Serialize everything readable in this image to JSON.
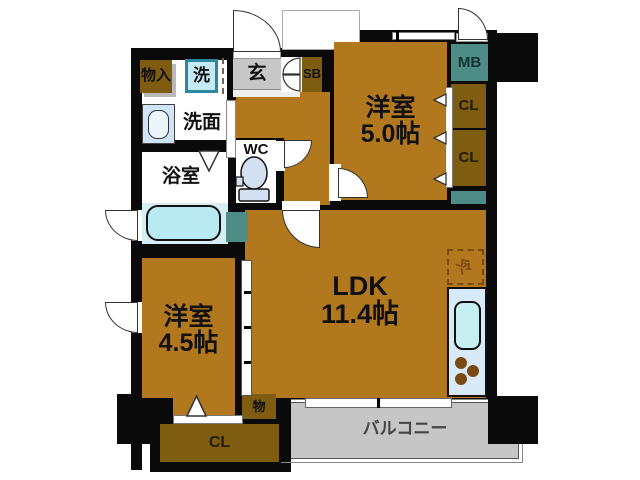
{
  "rooms": {
    "bedroom_top": {
      "name": "洋室",
      "size": "5.0帖"
    },
    "bedroom_left": {
      "name": "洋室",
      "size": "4.5帖"
    },
    "ldk": {
      "name": "LDK",
      "size": "11.4帖"
    },
    "bath": {
      "label": "浴室"
    },
    "washroom": {
      "label": "洗面"
    },
    "washer": {
      "label": "洗"
    },
    "storage_hall": {
      "label": "物入"
    },
    "entry": {
      "label": "玄"
    },
    "shoe_box": {
      "label": "SB"
    },
    "meter_box": {
      "label": "MB"
    },
    "wc": {
      "label": "WC"
    },
    "closet_right_top": {
      "label": "CL"
    },
    "closet_right_bottom": {
      "label": "CL"
    },
    "closet_bottom": {
      "label": "CL"
    },
    "storage_small": {
      "label": "物"
    },
    "balcony": {
      "label": "バルコニー"
    },
    "fridge": {
      "label": "冷"
    }
  },
  "colors": {
    "wall": "#0a0a0a",
    "floor_wood": "#b1781e",
    "closet_brown": "#7e5c10",
    "entry_gray": "#c7c7c7",
    "balcony_gray": "#c6c6c6",
    "utility_teal": "#4e8c86",
    "bath_blue": "#d6edf6",
    "tub_blue": "#b9e9f1",
    "kitchen_blue": "#d8eaf7"
  }
}
